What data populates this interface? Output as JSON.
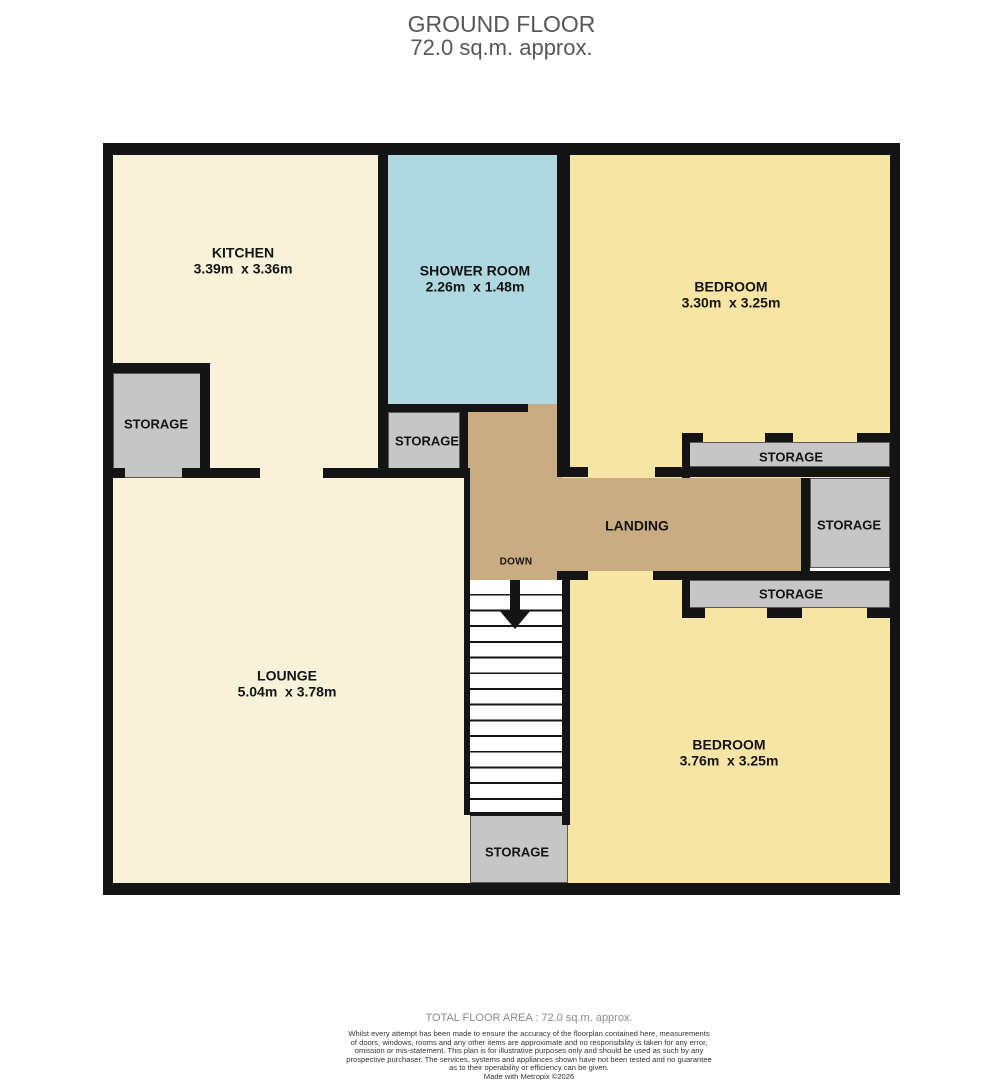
{
  "title": {
    "line1": "GROUND FLOOR",
    "line2": "72.0 sq.m. approx."
  },
  "rooms": {
    "kitchen": {
      "name": "KITCHEN",
      "dims": "3.39m  x 3.36m"
    },
    "shower_room": {
      "name": "SHOWER ROOM",
      "dims": "2.26m  x 1.48m"
    },
    "bedroom_top": {
      "name": "BEDROOM",
      "dims": "3.30m  x 3.25m"
    },
    "lounge": {
      "name": "LOUNGE",
      "dims": "5.04m  x 3.78m"
    },
    "bedroom_bottom": {
      "name": "BEDROOM",
      "dims": "3.76m  x 3.25m"
    },
    "landing": {
      "name": "LANDING"
    }
  },
  "stairs": {
    "direction_label": "DOWN"
  },
  "storages": [
    {
      "label": "STORAGE",
      "location": "kitchen-left"
    },
    {
      "label": "STORAGE",
      "location": "under-shower-room"
    },
    {
      "label": "STORAGE",
      "location": "bedroom-top-strip"
    },
    {
      "label": "STORAGE",
      "location": "landing-right"
    },
    {
      "label": "STORAGE",
      "location": "bedroom-bottom-strip"
    },
    {
      "label": "STORAGE",
      "location": "under-stairs"
    }
  ],
  "footer": {
    "total_area": "TOTAL FLOOR AREA : 72.0 sq.m. approx.",
    "disclaimer_lines": [
      "Whilst every attempt has been made to ensure the accuracy of the floorplan contained here, measurements",
      "of doors, windows, rooms and any other items are approximate and no responsibility is taken for any error,",
      "omission or mis-statement. This plan is for illustrative purposes only and should be used as such by any",
      "prospective purchaser. The services, systems and appliances shown have not been tested and no guarantee",
      "as to their operability or efficiency can be given."
    ],
    "credit": "Made with Metropix ©2026"
  },
  "colors": {
    "floor_cream": "#F8F2DA",
    "floor_yellow": "#F7E5A6",
    "floor_blue": "#AFD8E0",
    "floor_tan": "#C9AC82",
    "storage_gray": "#C6C6C6",
    "wall_black": "#141414",
    "title_gray": "#57575A"
  }
}
